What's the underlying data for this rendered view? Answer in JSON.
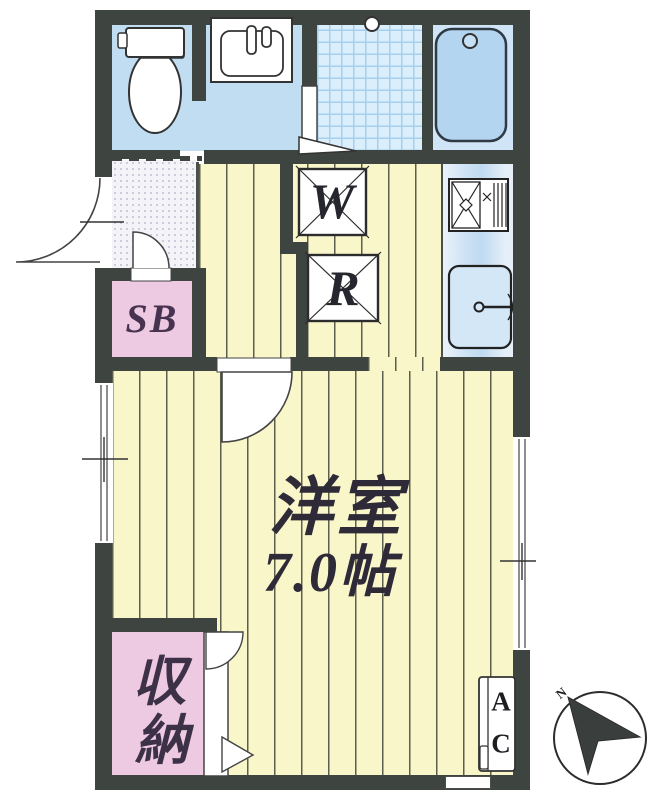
{
  "plan": {
    "main_room": {
      "name": "洋室",
      "size": "7.0帖"
    },
    "fixtures": {
      "washer_label": "W",
      "fridge_label": "R",
      "shoebox_label": "SB",
      "ac_top": "A",
      "ac_bottom": "C"
    },
    "storage": {
      "top": "収",
      "bottom": "納"
    },
    "compass": {
      "north": "N"
    },
    "colors": {
      "wall": "#3e4540",
      "flooring": "#f9f6ca",
      "wet_area": "#c1ddf2",
      "tile": "#daeefb",
      "bath": "#b3d5f0",
      "closet_pink": "#edc9e2"
    }
  }
}
